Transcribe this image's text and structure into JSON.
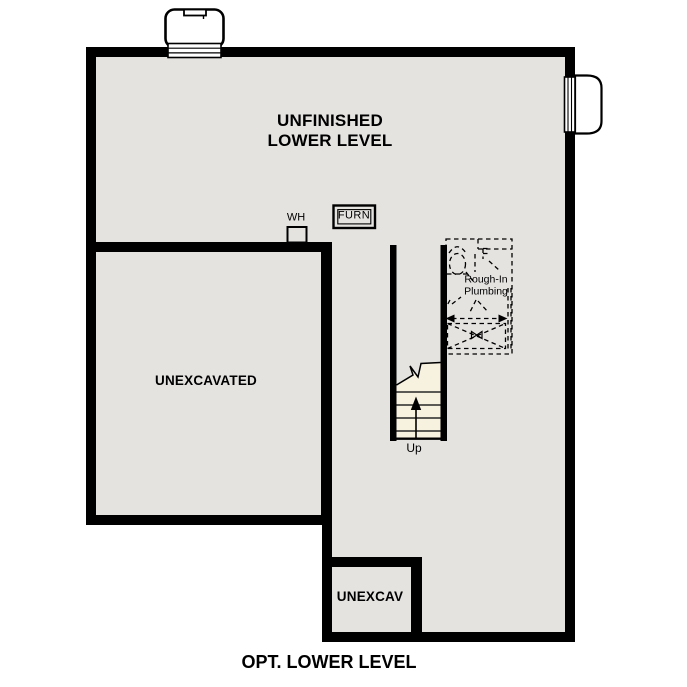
{
  "plan_title": "OPT. LOWER LEVEL",
  "rooms": {
    "unfinished": {
      "line1": "UNFINISHED",
      "line2": "LOWER LEVEL"
    },
    "unexcavated": {
      "label": "UNEXCAVATED"
    },
    "unexcav": {
      "label": "UNEXCAV"
    }
  },
  "annotations": {
    "water_heater": "WH",
    "furnace": "FURN",
    "stair_direction": "Up",
    "rough_in": {
      "line1": "Rough-In",
      "line2": "Plumbing"
    }
  },
  "colors": {
    "wall": "#000000",
    "floor_fill": "#e5e3e0",
    "stair_tread_fill": "#f7f1df",
    "page_background": "#ffffff",
    "line": "#000000"
  }
}
